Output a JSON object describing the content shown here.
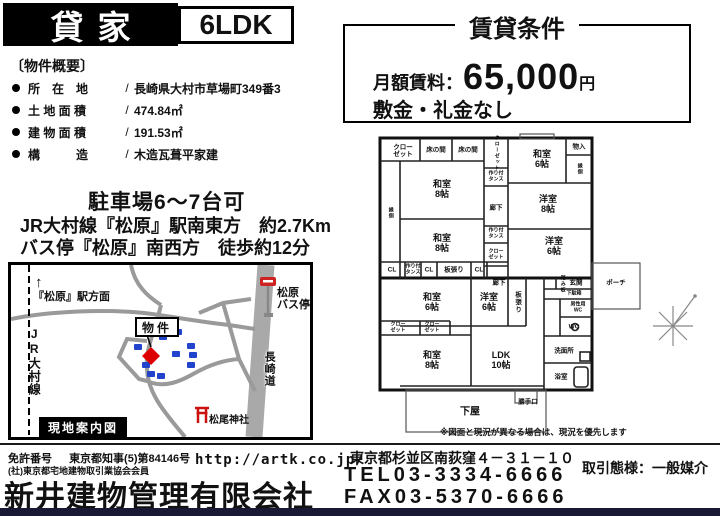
{
  "header": {
    "sale_type": "貸家",
    "layout": "6LDK"
  },
  "rental_terms": {
    "title": "賃貸条件",
    "rent_label": "月額賃料：",
    "rent_amount": "65,000",
    "rent_unit": "円",
    "deposit_note": "敷金・礼金なし"
  },
  "overview": {
    "title": "〔物件概要〕",
    "separator": "/",
    "items": [
      {
        "label": "所　在　地",
        "value": "長崎県大村市草場町349番3"
      },
      {
        "label": "土 地 面 積",
        "value": "474.84㎡"
      },
      {
        "label": "建 物 面 積",
        "value": "191.53㎡"
      },
      {
        "label": "構　　　造",
        "value": "木造瓦葺平家建"
      }
    ]
  },
  "parking": "駐車場6〜7台可",
  "access": {
    "line1": "JR大村線『松原』駅南東方　約2.7Km",
    "line2": "バス停『松原』南西方　徒歩約12分"
  },
  "map": {
    "caption": "現地案内図",
    "station_direction": "『松原』駅方面",
    "station_arrow": "↑",
    "rail_line": "JR大村線",
    "bus_stop": "松原\nバス停",
    "property_label": "物件",
    "expressway": "長崎道",
    "shrine": "松尾神社",
    "marker_color": "#dd0000",
    "house_color": "#2244cc",
    "torii_color": "#cc1111",
    "bus_sign_color": "#cc2222"
  },
  "floorplan": {
    "rooms": {
      "closet_tl": "クロー\nゼット",
      "tokonoma1": "床の間",
      "tokonoma2": "床の間",
      "washitsu8_1": "和室\n8帖",
      "washitsu8_2": "和室\n8帖",
      "closet_v1": "クローゼット",
      "tansu1": "作り付\nタンス",
      "washitsu6_top": "和室\n6帖",
      "mono_ire": "物入",
      "engawa_right": "縁側",
      "engawa_left": "縁側",
      "yoshitsu8": "洋室\n8帖",
      "rouka1": "廊下",
      "tansu2": "作り付\nタンス",
      "closet_v2": "クロー\nゼット",
      "yoshitsu6_right": "洋室\n6帖",
      "cl1": "CL",
      "tansu3": "作り付\nタンス",
      "cl2": "CL",
      "itabari1": "板張り",
      "cl3": "CL",
      "washitsu6_b": "和室\n6帖",
      "yoshitsu6_b": "洋室\n6帖",
      "itabari2": "板張り",
      "rouka2": "廊下",
      "fumiita": "踏み板",
      "genkan": "玄関",
      "porch": "ポーチ",
      "getabako": "下駄箱",
      "mens_wc": "男性用\nWC",
      "wc": "WC",
      "closet_b1": "クロー\nゼット",
      "closet_b2": "クロー\nゼット",
      "washitsu8_3": "和室\n8帖",
      "ldk": "LDK\n10帖",
      "senmenjo": "洗面所",
      "yokushitsu": "浴室",
      "geya": "下屋",
      "katteguchi": "勝手口"
    },
    "note": "※図面と現況が異なる場合は、現況を優先します"
  },
  "footer": {
    "license_label": "免許番号",
    "license_no": "東京都知事(5)第84146号",
    "association": "(社)東京都宅地建物取引業協会会員",
    "company": "新井建物管理有限会社",
    "url": "http://artk.co.jp/",
    "address": "東京都杉並区南荻窪４－３１－１０",
    "tel": "TEL03-3334-6666",
    "fax": "FAX03-5370-6666",
    "transaction_type": "取引態様：一般媒介"
  }
}
